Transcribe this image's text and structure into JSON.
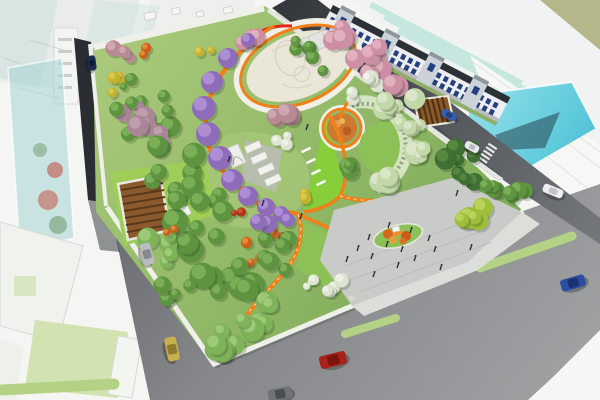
{
  "meta": {
    "title": "Aerial rendering of park master plan",
    "canvas_w": 600,
    "canvas_h": 400
  },
  "palette": {
    "bg": "#f5f6f3",
    "olive_ground": "#b5b68a",
    "glass_white": "#f1f3f2",
    "glass_teal": "#c6e7df",
    "glass_cyan": "#55c9da",
    "glass_reflection": "#27444e",
    "sketch_block": "#e9ece9",
    "sketch_edge": "#d2d7d2",
    "tower_glass": "#a8d4d6",
    "road": "#8f9194",
    "road_dark": "#2a2d31",
    "road_ne": "#3c4045",
    "sidewalk": "#eef0e9",
    "median_green": "#b3d286",
    "park_base": "#84b15c",
    "park_base_light": "#a9c87a",
    "lawn_bright": "#9ecd58",
    "lawn_mid": "#8cc157",
    "lime_lawn": "#86cf3a",
    "plaza_cream": "#eae6d8",
    "plaza_gray": "#c9cbc8",
    "plaza_walk": "#dcded9",
    "path_orange": "#f28018",
    "path_red": "#e22810",
    "flower_bed": "#cf7a33",
    "pergola_wood": "#8a5a2c",
    "pergola_wood_dark": "#5a3818",
    "pergola_vine": "#d9e7c8",
    "white_corner": "#f6f7f4",
    "people": "#26262a"
  },
  "scene": {
    "tree_palette": {
      "green": [
        "#5e9340",
        "#82b75c"
      ],
      "lightgreen": [
        "#7fb35a",
        "#a5cf7e"
      ],
      "darkgreen": [
        "#3f6f33",
        "#5d8f44"
      ],
      "yellowgreen": [
        "#9dbf3a",
        "#c3d862"
      ],
      "palegreen": [
        "#c2d8a8",
        "#e0ead0"
      ],
      "yellow": [
        "#c2b22e",
        "#ddd05a"
      ],
      "orange": [
        "#cc5f1d",
        "#e8933f"
      ],
      "red": [
        "#b03418",
        "#d85c2c"
      ],
      "pink": [
        "#cc8fa4",
        "#e7b7c6"
      ],
      "rose": [
        "#b98a96",
        "#d4aeb6"
      ],
      "mauve": [
        "#a88597",
        "#c4a5b4"
      ],
      "white": [
        "#dde4d2",
        "#f2f4ea"
      ]
    },
    "tree_clusters": [
      [
        125,
        57,
        12,
        10,
        6,
        3,
        "rose"
      ],
      [
        116,
        82,
        9,
        11,
        6,
        4,
        "yellow"
      ],
      [
        205,
        55,
        8,
        8,
        5,
        2,
        "yellow"
      ],
      [
        143,
        53,
        6,
        6,
        4,
        2,
        "orange"
      ],
      [
        148,
        120,
        24,
        26,
        8,
        8,
        "green"
      ],
      [
        135,
        112,
        15,
        15,
        8,
        6,
        "mauve"
      ],
      [
        160,
        137,
        11,
        11,
        7,
        4,
        "mauve"
      ],
      [
        128,
        95,
        12,
        16,
        6,
        4,
        "green"
      ],
      [
        250,
        35,
        11,
        8,
        7,
        4,
        "pink"
      ],
      [
        340,
        34,
        12,
        10,
        8,
        4,
        "pink"
      ],
      [
        310,
        58,
        22,
        18,
        7,
        6,
        "green"
      ],
      [
        368,
        62,
        20,
        18,
        10,
        7,
        "pink"
      ],
      [
        372,
        80,
        8,
        8,
        6,
        3,
        "white"
      ],
      [
        392,
        88,
        9,
        9,
        8,
        3,
        "pink"
      ],
      [
        352,
        93,
        6,
        6,
        5,
        2,
        "white"
      ],
      [
        170,
        170,
        26,
        28,
        9,
        9,
        "green"
      ],
      [
        285,
        112,
        15,
        10,
        8,
        5,
        "rose"
      ],
      [
        280,
        140,
        8,
        6,
        6,
        3,
        "white"
      ],
      [
        300,
        196,
        6,
        6,
        5,
        2,
        "yellow"
      ],
      [
        200,
        225,
        28,
        30,
        10,
        10,
        "green"
      ],
      [
        160,
        250,
        15,
        15,
        8,
        5,
        "lightgreen"
      ],
      [
        172,
        232,
        6,
        6,
        4,
        2,
        "orange"
      ],
      [
        238,
        216,
        6,
        6,
        4,
        2,
        "red"
      ],
      [
        455,
        165,
        22,
        20,
        9,
        8,
        "darkgreen"
      ],
      [
        488,
        182,
        13,
        11,
        7,
        4,
        "green"
      ],
      [
        520,
        192,
        14,
        9,
        7,
        5,
        "green"
      ],
      [
        388,
        104,
        28,
        6,
        9,
        5,
        "palegreen"
      ],
      [
        420,
        138,
        8,
        20,
        9,
        4,
        "palegreen"
      ],
      [
        394,
        182,
        15,
        7,
        9,
        4,
        "palegreen"
      ],
      [
        408,
        122,
        10,
        10,
        7,
        3,
        "palegreen"
      ],
      [
        345,
        162,
        12,
        12,
        7,
        4,
        "green"
      ],
      [
        258,
        248,
        18,
        16,
        5,
        6,
        "orange"
      ],
      [
        288,
        240,
        7,
        7,
        4,
        2,
        "red"
      ],
      [
        225,
        285,
        28,
        28,
        10,
        9,
        "green"
      ],
      [
        178,
        300,
        16,
        15,
        8,
        5,
        "green"
      ],
      [
        468,
        212,
        16,
        13,
        8,
        6,
        "yellowgreen"
      ],
      [
        280,
        255,
        16,
        18,
        8,
        6,
        "green"
      ],
      [
        222,
        335,
        20,
        18,
        9,
        7,
        "lightgreen"
      ],
      [
        255,
        315,
        18,
        16,
        9,
        6,
        "lightgreen"
      ],
      [
        332,
        288,
        13,
        9,
        6,
        5,
        "white"
      ],
      [
        307,
        285,
        7,
        6,
        5,
        3,
        "white"
      ]
    ],
    "wisteria": {
      "colors": [
        "#8f6cba",
        "#b394d8"
      ],
      "blobs": [
        [
          228,
          58,
          10
        ],
        [
          212,
          82,
          11
        ],
        [
          204,
          108,
          12
        ],
        [
          208,
          134,
          12
        ],
        [
          220,
          158,
          12
        ],
        [
          232,
          180,
          11
        ],
        [
          248,
          196,
          10
        ],
        [
          266,
          207,
          9
        ],
        [
          281,
          214,
          8
        ],
        [
          268,
          224,
          9
        ],
        [
          248,
          40,
          7
        ],
        [
          288,
          220,
          7
        ],
        [
          258,
          222,
          8
        ]
      ]
    },
    "row_houses": {
      "x": 333,
      "y": 5,
      "angle": 27.5,
      "length": 200,
      "depth": 26,
      "facade": "#eceef0",
      "base": "#dfe3e6",
      "roof": "#2c3138",
      "tower": "#ccd2d8",
      "tower_cap": "#8e969e",
      "window": "#24407e",
      "towers": [
        8,
        58,
        108,
        158
      ],
      "window_step": 8,
      "window_rows": [
        11,
        19
      ]
    },
    "cars": [
      {
        "name": "red-car",
        "x": 333,
        "y": 360,
        "angle": -14,
        "len": 27,
        "wid": 13,
        "body": "#a82219",
        "top": "#7a140e"
      },
      {
        "name": "blue-car",
        "x": 573,
        "y": 283,
        "angle": -16,
        "len": 25,
        "wid": 12,
        "body": "#2b4fa0",
        "top": "#1c3370"
      },
      {
        "name": "yellow-car",
        "x": 172,
        "y": 349,
        "angle": 78,
        "len": 24,
        "wid": 12,
        "body": "#c9b04e",
        "top": "#8f7a30"
      },
      {
        "name": "silver-car",
        "x": 147,
        "y": 254,
        "angle": 75,
        "len": 22,
        "wid": 11,
        "body": "#b9bcc0",
        "top": "#85898e"
      },
      {
        "name": "navy-car",
        "x": 92,
        "y": 63,
        "angle": 82,
        "len": 15,
        "wid": 8,
        "body": "#1d2c52",
        "top": "#101a34"
      },
      {
        "name": "blue-car-ne",
        "x": 449,
        "y": 115,
        "angle": 28,
        "len": 16,
        "wid": 8,
        "body": "#3a5cae",
        "top": "#24407e"
      },
      {
        "name": "white-car-ne",
        "x": 472,
        "y": 147,
        "angle": 28,
        "len": 15,
        "wid": 8,
        "body": "#e8eaec",
        "top": "#b8bcc2"
      },
      {
        "name": "white-bus",
        "x": 553,
        "y": 191,
        "angle": 22,
        "len": 21,
        "wid": 9,
        "body": "#eceef0",
        "top": "#c2c6cc"
      },
      {
        "name": "gray-car",
        "x": 280,
        "y": 394,
        "angle": -12,
        "len": 24,
        "wid": 12,
        "body": "#6f7276",
        "top": "#4a4d52"
      }
    ],
    "medians": [
      [
        480,
        268,
        572,
        236,
        9
      ],
      [
        345,
        334,
        396,
        318,
        8
      ],
      [
        2,
        390,
        114,
        384,
        11
      ]
    ],
    "people": [
      [
        357,
        251
      ],
      [
        371,
        259
      ],
      [
        386,
        247
      ],
      [
        401,
        252
      ],
      [
        397,
        268
      ],
      [
        414,
        261
      ],
      [
        373,
        277
      ],
      [
        410,
        233
      ],
      [
        428,
        241
      ],
      [
        388,
        228
      ],
      [
        346,
        262
      ],
      [
        434,
        252
      ],
      [
        368,
        240
      ],
      [
        300,
        219
      ],
      [
        262,
        206
      ],
      [
        306,
        130
      ],
      [
        228,
        162
      ],
      [
        456,
        196
      ],
      [
        470,
        250
      ],
      [
        440,
        270
      ]
    ],
    "plaza_island_shrubs": [
      [
        388,
        234,
        5,
        "#d86820"
      ],
      [
        397,
        232,
        4.5,
        "#e89030"
      ],
      [
        406,
        236,
        5,
        "#cf5a18"
      ],
      [
        393,
        240,
        4,
        "#e0a040"
      ],
      [
        403,
        241,
        3.5,
        "#d87028"
      ]
    ]
  }
}
